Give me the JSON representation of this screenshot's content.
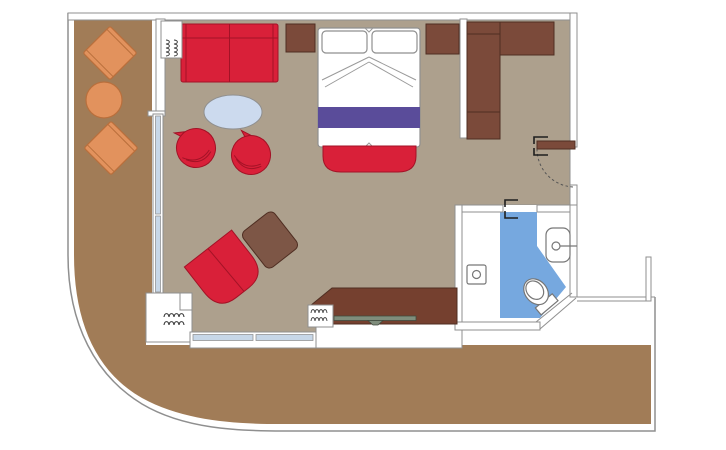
{
  "plan": {
    "kind": "cruise-stateroom-floor-plan",
    "areas": [
      {
        "name": "wrap-around-balcony-deck",
        "floor_color_key": "deck"
      },
      {
        "name": "living-sleeping-room",
        "floor_color_key": "floor"
      },
      {
        "name": "entry-corridor",
        "floor_color_key": "floor"
      },
      {
        "name": "bathroom",
        "floor_color_key": "bathroom_blue"
      }
    ],
    "furniture": [
      {
        "name": "balcony-deck-chair-upper"
      },
      {
        "name": "balcony-round-table"
      },
      {
        "name": "balcony-deck-chair-lower"
      },
      {
        "name": "red-sofa"
      },
      {
        "name": "nightstand-left"
      },
      {
        "name": "nightstand-right"
      },
      {
        "name": "double-bed"
      },
      {
        "name": "foot-of-bed-bench"
      },
      {
        "name": "oval-coffee-table"
      },
      {
        "name": "tub-chair-left"
      },
      {
        "name": "tub-chair-right"
      },
      {
        "name": "lounge-chair"
      },
      {
        "name": "ottoman"
      },
      {
        "name": "desk-dresser-with-tv"
      },
      {
        "name": "wardrobe-closet"
      },
      {
        "name": "entry-door"
      },
      {
        "name": "bathroom-sink"
      },
      {
        "name": "toilet"
      },
      {
        "name": "shower-drain"
      },
      {
        "name": "curtain-symbol-top-left"
      },
      {
        "name": "curtain-symbol-bottom-left"
      },
      {
        "name": "curtain-symbol-desk"
      }
    ]
  },
  "colors": {
    "deck": "#A17C57",
    "floor": "#ADA08D",
    "red": "#D92039",
    "red_dark": "#A31226",
    "wood_dark": "#7B4A3A",
    "wood_desk": "#75402F",
    "wood_edge": "#4F2E22",
    "ottoman": "#7D5646",
    "balcony_furniture": "#E2925D",
    "balcony_furniture_dark": "#B96F3C",
    "bathroom_blue": "#76A8DF",
    "bed_purple": "#5A4C9A",
    "table_top": "#CCDAEE",
    "glass": "#C7D7E8",
    "wall_line": "#8F8F8F",
    "tv": "#7F8D7C"
  }
}
